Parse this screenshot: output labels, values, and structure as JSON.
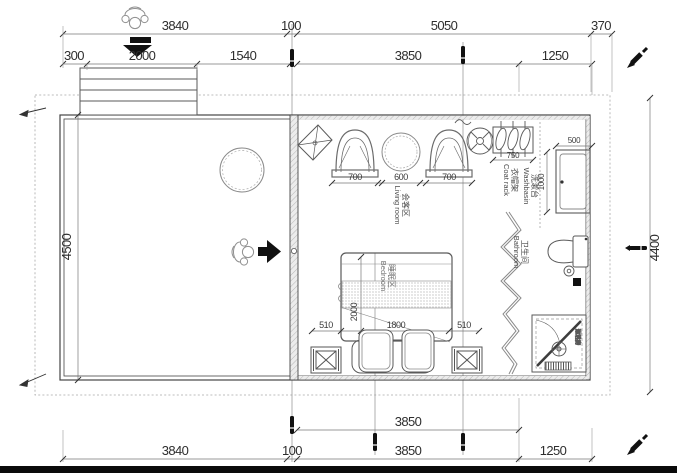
{
  "dims": {
    "top_a": [
      "3840",
      "100",
      "5050",
      "370"
    ],
    "top_b": [
      "300",
      "2000",
      "1540",
      "3850",
      "1250"
    ],
    "left": "4500",
    "right": "4400",
    "bottom_a": "3850",
    "bottom_b": [
      "3840",
      "100",
      "3850",
      "1250"
    ],
    "seating": [
      "700",
      "600",
      "700"
    ],
    "coat_rack": "750",
    "basin_width": "500",
    "basin_depth": "1000",
    "bed_length": "2000",
    "bed_width": "1800",
    "bed_side_left": "510",
    "bed_side_right": "510"
  },
  "rooms": {
    "living": {
      "zh": "会客区",
      "en": "Living room"
    },
    "bedroom": {
      "zh": "睡眠区",
      "en": "Bedroom"
    },
    "bathroom": {
      "zh": "卫生间",
      "en": "Bathroom"
    },
    "washbasin": {
      "zh": "洗漱台",
      "en": "Washbasin"
    },
    "coat_rack": {
      "zh": "衣帽架",
      "en": "Coat rack"
    },
    "shower": {
      "zh": "淋浴房"
    }
  },
  "colors": {
    "line": "#454545",
    "dim_text": "#2e2e2e",
    "shower_label": "#6779a8"
  }
}
